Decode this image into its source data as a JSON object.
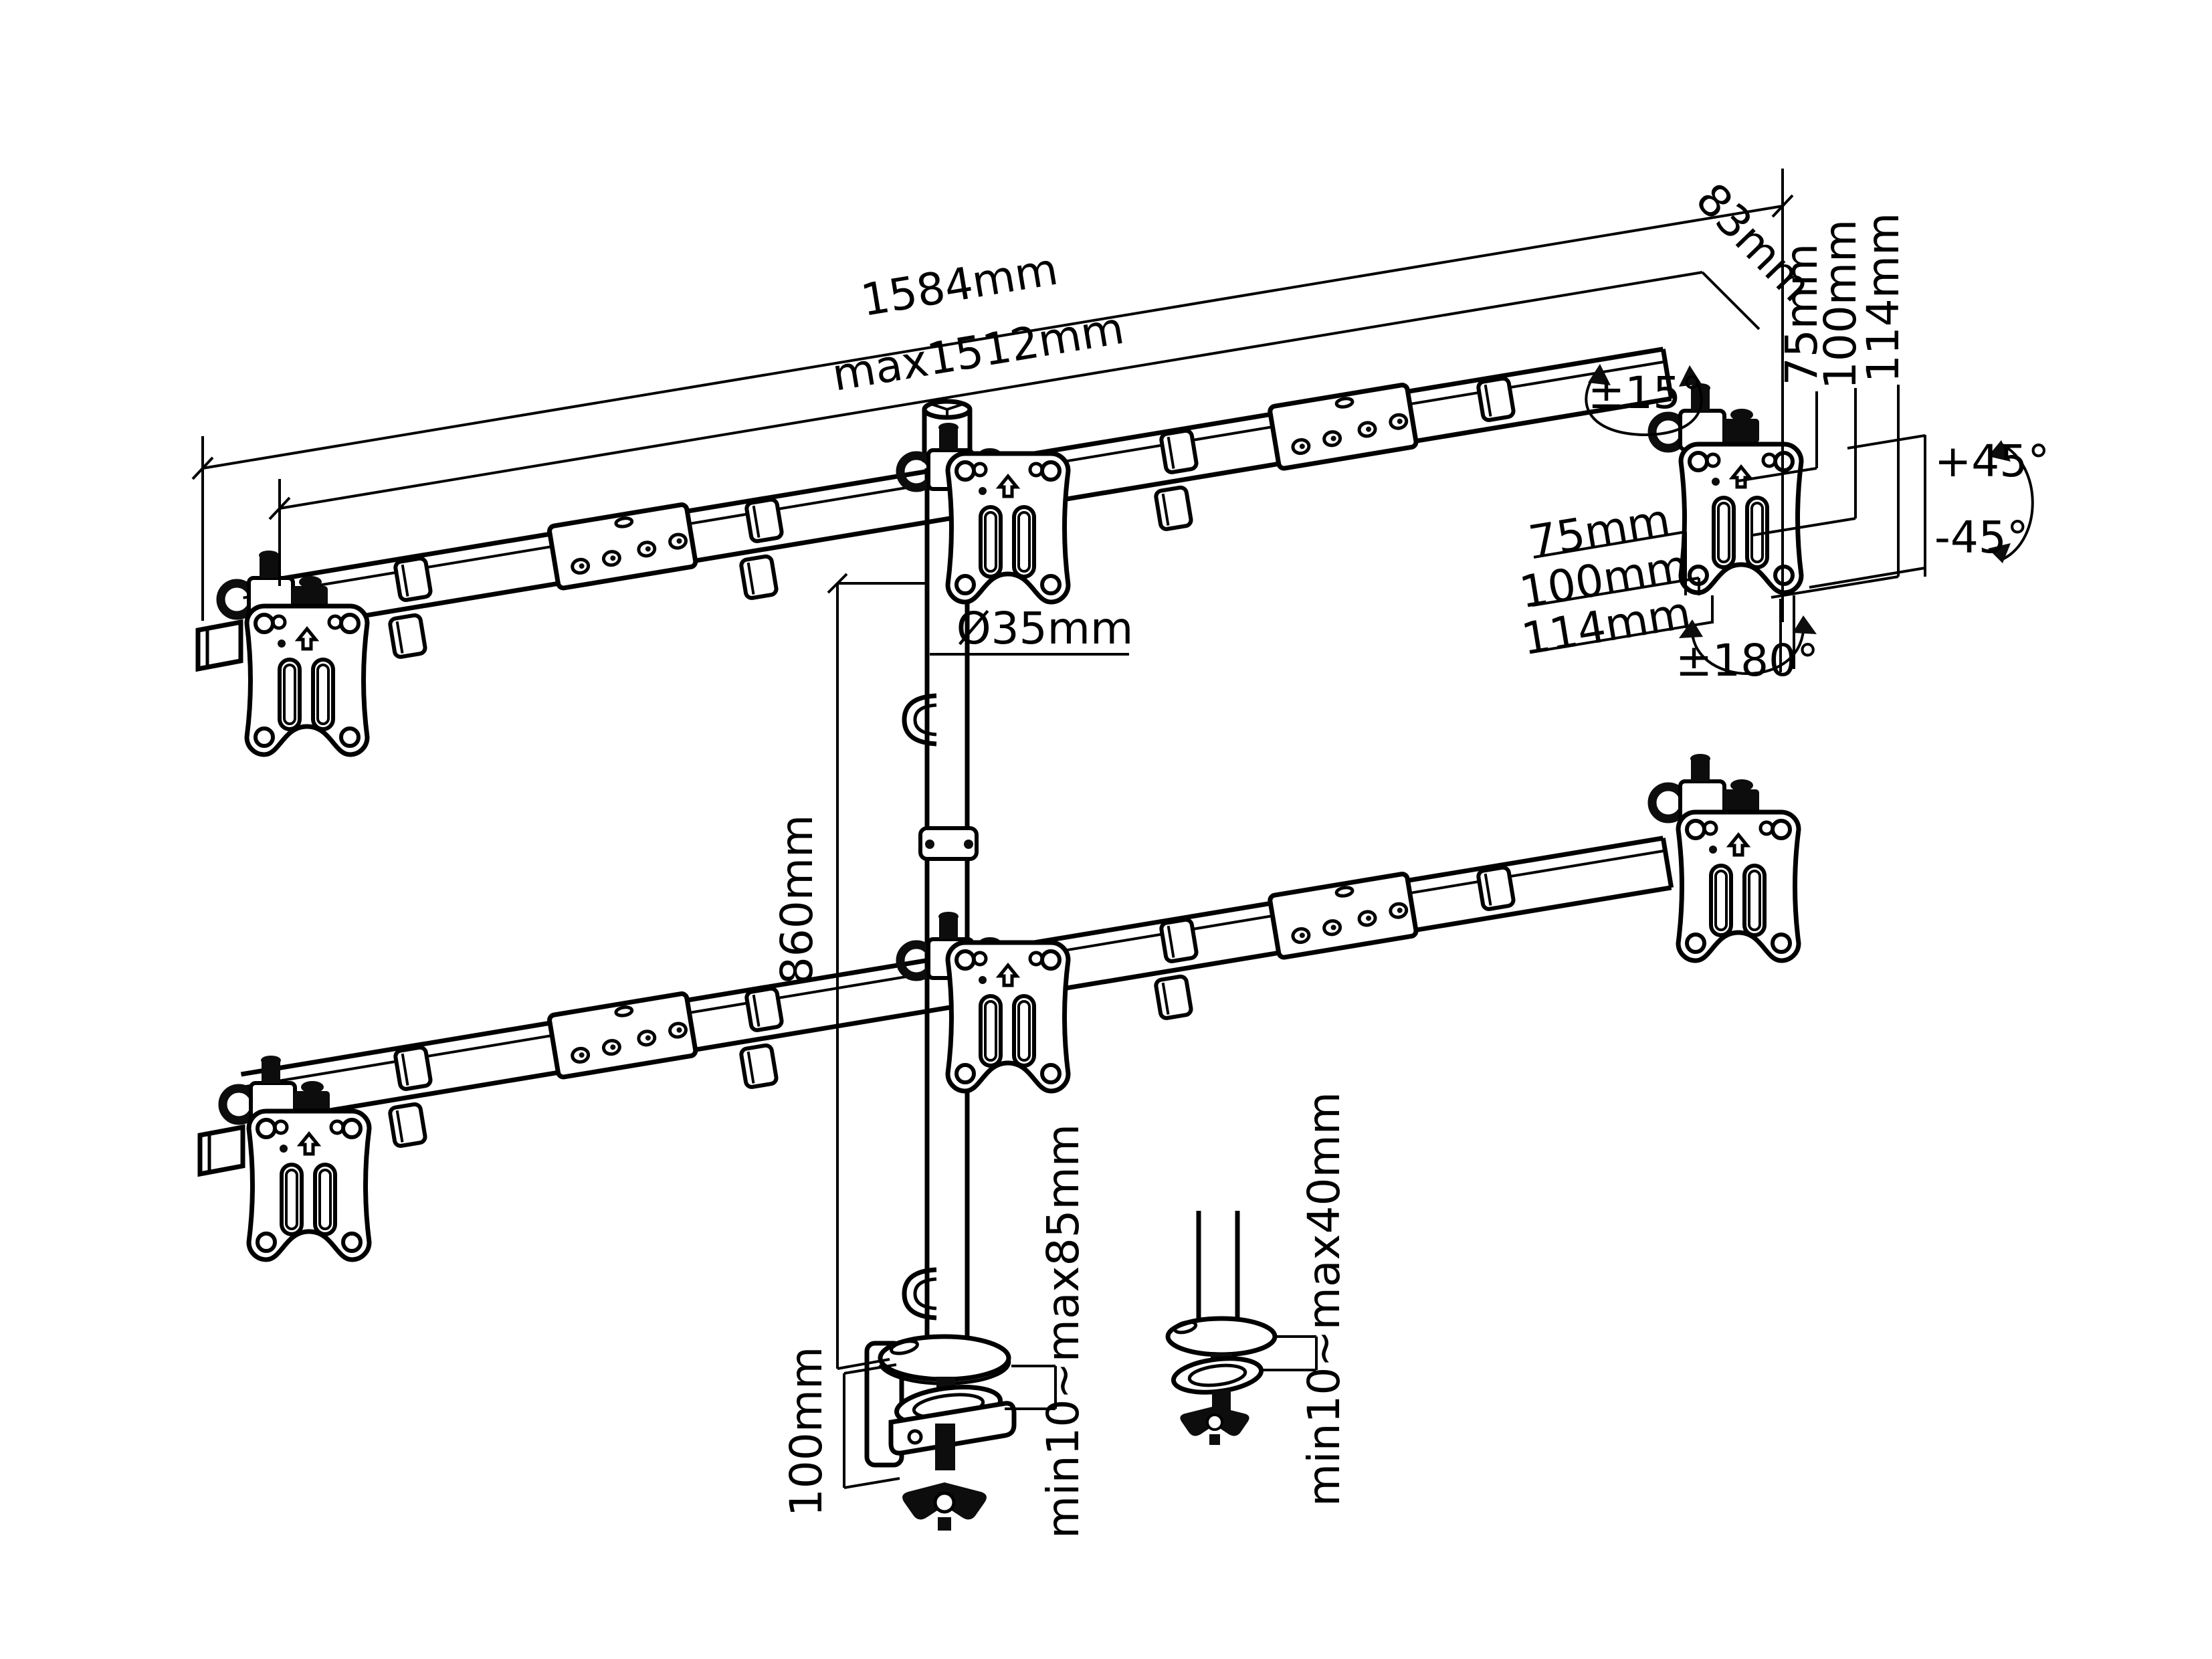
{
  "colors": {
    "background": "#ffffff",
    "line": "#000000"
  },
  "diagram": {
    "labels": {
      "overall_width": "1584mm",
      "max_width": "max1512mm",
      "arm_depth": "83mm",
      "swivel_small": "±15°",
      "vesa_col_75": "75mm",
      "vesa_col_100": "100mm",
      "vesa_col_114": "114mm",
      "tilt_up": "+45°",
      "tilt_down": "-45°",
      "vesa_row_75": "75mm",
      "vesa_row_100": "100mm",
      "vesa_row_114": "114mm",
      "rotation_180": "±180°",
      "pole_diameter": "Ø35mm",
      "pole_height": "860mm",
      "clamp_height": "100mm",
      "desk_thickness_clamp": "min10~max85mm",
      "desk_thickness_grommet": "min10~max40mm"
    }
  }
}
